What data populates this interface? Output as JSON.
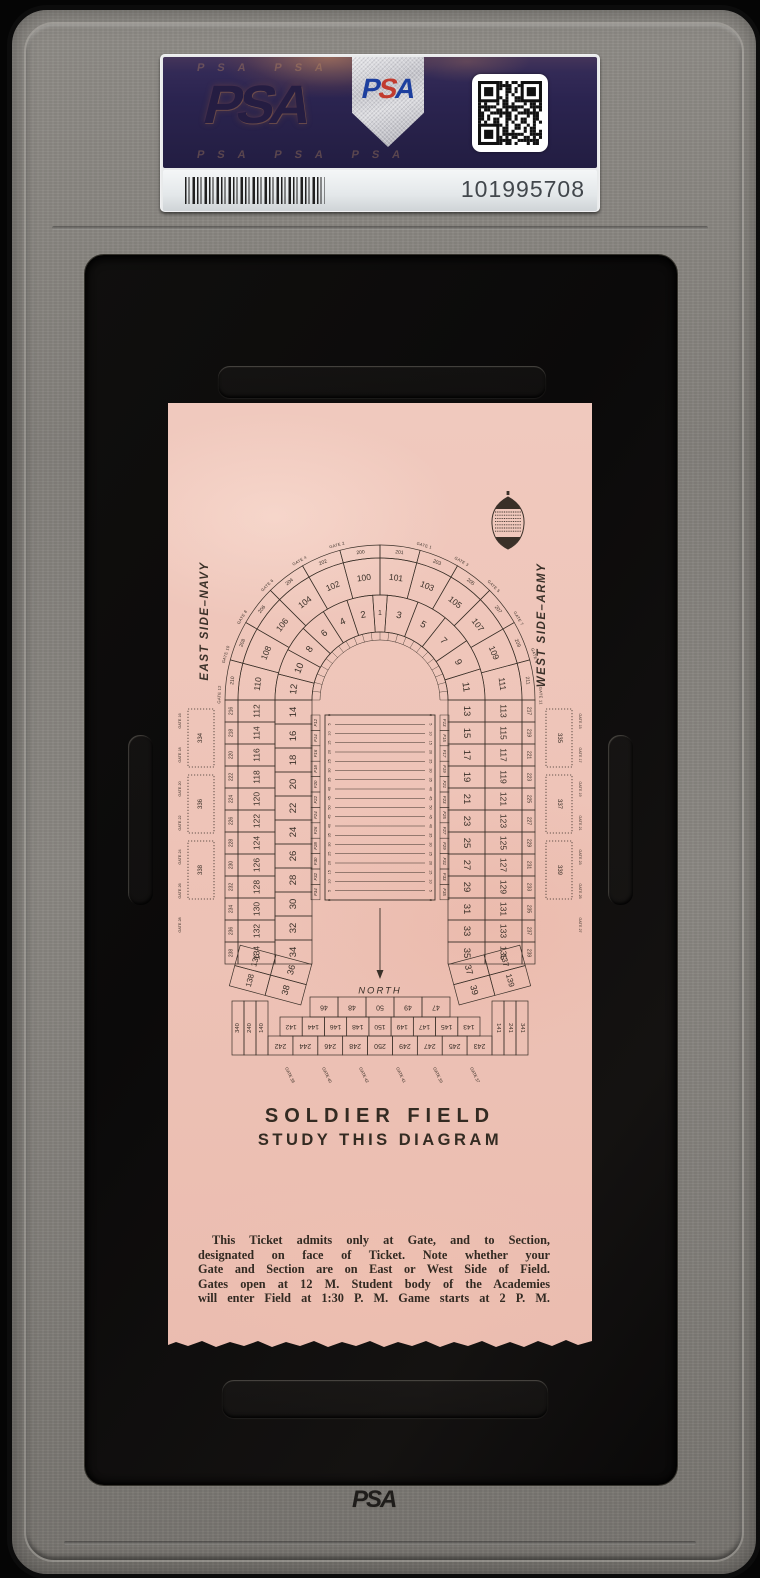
{
  "slab": {
    "brand": "PSA",
    "cert_number": "101995708",
    "emboss_logo": "PSA",
    "label": {
      "hologram_logo": "PSA",
      "hologram_pattern": "PSA PSA PSA",
      "shield_letters": [
        "P",
        "S",
        "A"
      ]
    },
    "colors": {
      "frame_gray": "#86837e",
      "window_black": "#0d0c0b",
      "label_navy": "#2b2450",
      "label_strip": "#eef0f2",
      "shield_silver": "#c9c9cd",
      "psa_blue": "#1d3f9e",
      "psa_red": "#c23b2e"
    }
  },
  "ticket": {
    "paper_color": "#eec2b6",
    "ink_color": "#3a3028",
    "title": "SOLDIER FIELD",
    "subtitle": "STUDY THIS DIAGRAM",
    "east_label": "EAST SIDE–NAVY",
    "west_label": "WEST SIDE–ARMY",
    "north_label": "NORTH",
    "notice_lines": [
      "This Ticket admits only at Gate, and to Section,",
      "designated on face of Ticket.  Note whether your",
      "Gate and Section are on East or West Side of Field.",
      "Gates open at 12 M.  Student body of the Academies",
      "will enter Field at 1:30 P. M.  Game starts at 2 P. M."
    ],
    "diagram": {
      "inner_arc_left": [
        12,
        10,
        8,
        6,
        4,
        2
      ],
      "inner_arc_center": [
        1
      ],
      "inner_arc_right": [
        3,
        5,
        7,
        9,
        11
      ],
      "inner_col_left": [
        14,
        16,
        18,
        20,
        22,
        24,
        26,
        28,
        30,
        32,
        34
      ],
      "inner_col_right": [
        13,
        15,
        17,
        19,
        21,
        23,
        25,
        27,
        29,
        31,
        33,
        35
      ],
      "inner_bend_left": [
        36,
        38
      ],
      "inner_bend_right": [
        37,
        39
      ],
      "outer_arc_left": [
        110,
        108,
        106,
        104,
        102,
        100
      ],
      "outer_arc_right": [
        101,
        103,
        105,
        107,
        109,
        111
      ],
      "outer_col_left": [
        112,
        114,
        116,
        118,
        120,
        122,
        124,
        126,
        128,
        130,
        132,
        134
      ],
      "outer_col_right": [
        113,
        115,
        117,
        119,
        121,
        123,
        125,
        127,
        129,
        131,
        133,
        135
      ],
      "outer_bend_left": [
        136,
        138
      ],
      "outer_bend_right": [
        137,
        139
      ],
      "ring200_arc_left": [
        210,
        208,
        206,
        204,
        202,
        200
      ],
      "ring200_arc_right": [
        201,
        203,
        205,
        207,
        209,
        211
      ],
      "ring200_col_left": [
        216,
        218,
        220,
        222,
        224,
        226,
        228,
        230,
        232,
        234,
        236,
        238
      ],
      "ring200_col_right": [
        217,
        219,
        221,
        223,
        225,
        227,
        229,
        231,
        233,
        235,
        237,
        239
      ],
      "corner_stack_left": [
        140,
        240,
        340
      ],
      "corner_stack_right": [
        141,
        241,
        341
      ],
      "field_col_left": [
        "F12",
        "F14",
        "F16",
        "F18",
        "F20",
        "F22",
        "F24",
        "F26",
        "F28",
        "F30",
        "F32",
        "F34"
      ],
      "field_col_right": [
        "F13",
        "F15",
        "F17",
        "F19",
        "F21",
        "F23",
        "F25",
        "F27",
        "F29",
        "F31",
        "F33",
        "F35"
      ],
      "south_row_top": [
        46,
        48,
        50,
        49,
        47
      ],
      "south_row_mid": [
        142,
        144,
        146,
        148,
        150,
        149,
        147,
        145,
        143
      ],
      "south_row_bottom": [
        242,
        244,
        246,
        248,
        250,
        249,
        247,
        245,
        243
      ],
      "arc_gates": [
        "GATE 12",
        "GATE 10",
        "GATE 8",
        "GATE 6",
        "GATE 4",
        "GATE 2",
        "GATE 1",
        "GATE 3",
        "GATE 5",
        "GATE 7",
        "GATE 9",
        "GATE 11"
      ],
      "side_gates_left": [
        16,
        18,
        20,
        22,
        24,
        26,
        28
      ],
      "side_gates_right": [
        15,
        17,
        19,
        21,
        23,
        25,
        27
      ],
      "south_gates": [
        "GATE 38",
        "GATE 40",
        "GATE 42",
        "GATE 41",
        "GATE 39",
        "GATE 37"
      ],
      "colonnade_left": [
        "334",
        "336",
        "338"
      ],
      "colonnade_right": [
        "335",
        "337",
        "339"
      ],
      "yard_labels": [
        0,
        5,
        10,
        15,
        20,
        25,
        30,
        35,
        40,
        45,
        50,
        45,
        40,
        35,
        30,
        25,
        20,
        15,
        10,
        5,
        0
      ]
    }
  }
}
